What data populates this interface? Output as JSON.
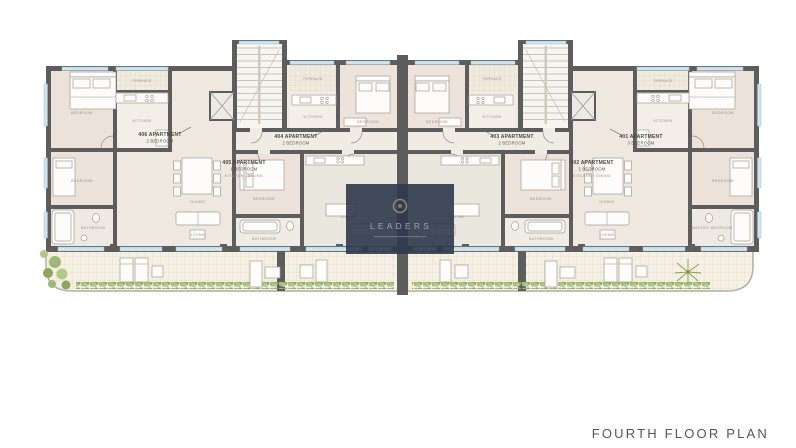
{
  "page": {
    "title": "FOURTH FLOOR PLAN"
  },
  "watermark": {
    "brand": "LEADERS"
  },
  "apartments": {
    "a406": {
      "name": "406 APARTMENT",
      "type": "2 BEDROOM"
    },
    "a405": {
      "name": "405 APARTMENT",
      "type": "1 BEDROOM"
    },
    "a404": {
      "name": "404 APARTMENT",
      "type": "2 BEDROOM"
    },
    "a403": {
      "name": "403 APARTMENT",
      "type": "2 BEDROOM"
    },
    "a402": {
      "name": "402 APARTMENT",
      "type": "1 BEDROOM"
    },
    "a401": {
      "name": "401 APARTMENT",
      "type": "3 BEDROOM"
    }
  },
  "room_labels": {
    "bedroom": "BEDROOM",
    "master_bedroom": "MASTER BEDROOM",
    "bathroom": "BATHROOM",
    "kitchen": "KITCHEN",
    "kitchen_dining": "KITCHEN / DINING",
    "dining": "DINING",
    "living": "LIVING",
    "terrace": "TERRACE"
  },
  "colors": {
    "wall": "#5d5d5d",
    "room_warm": "#ece2da",
    "room_light": "#f3eee7",
    "window": "#cfe4ee",
    "tile": "#f5f0e3",
    "hedge": "#a9c37f",
    "watermark_bg": "#2f394c",
    "label_text": "#4a4643",
    "title_text": "#55565a"
  }
}
